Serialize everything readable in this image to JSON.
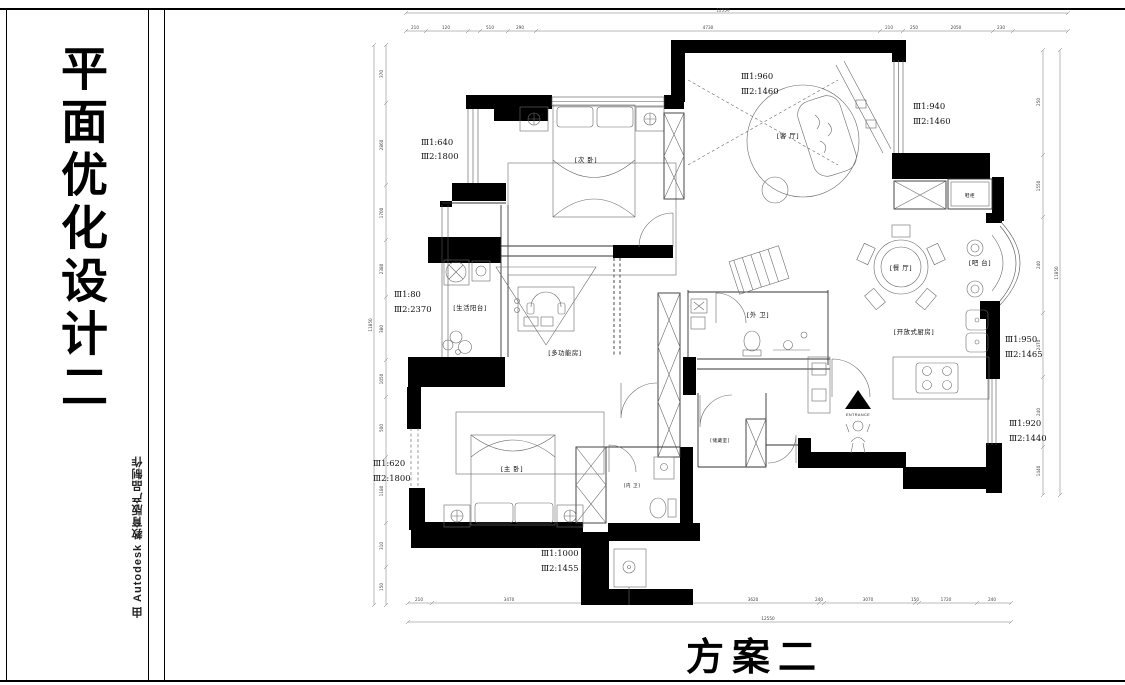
{
  "sheet": {
    "side_title": "平面优化设计二",
    "credit": "由 Autodesk 教育版产品制作",
    "plan_title": "方案二"
  },
  "rooms": {
    "bedroom2": "[次 卧]",
    "living": "[客 厅]",
    "balcony": "[生活阳台]",
    "multi": "[多功能房]",
    "bath_outer": "[外 卫]",
    "dining": "[餐 厅]",
    "bar": "[吧 台]",
    "kitchen": "[开放式厨房]",
    "shoe_cabinet": "鞋柜",
    "master": "[主 卧]",
    "bath_inner": "[内 卫]",
    "storage": "[储藏室]"
  },
  "entrance_label": "ENTRANCE",
  "annotations": {
    "leftTop": {
      "l1": "Ⅲ1:640",
      "l2": "Ⅲ2:1800"
    },
    "top": {
      "l1": "Ⅲ1:960",
      "l2": "Ⅲ2:1460"
    },
    "topRight": {
      "l1": "Ⅲ1:940",
      "l2": "Ⅲ2:1460"
    },
    "leftMid": {
      "l1": "Ⅲ1:80",
      "l2": "Ⅲ2:2370"
    },
    "rightMid": {
      "l1": "Ⅲ1:950",
      "l2": "Ⅲ2:1465"
    },
    "leftBottom": {
      "l1": "Ⅲ1:620",
      "l2": "Ⅲ2:1800"
    },
    "rightLow": {
      "l1": "Ⅲ1:920",
      "l2": "Ⅲ2:1440"
    },
    "bottom": {
      "l1": "Ⅲ1:1000",
      "l2": "Ⅲ2:1455"
    }
  },
  "dims": {
    "top_overall": "12550",
    "bottom_overall": "12550",
    "left_overall": "11850",
    "right_overall": "11850",
    "top": [
      "210",
      "120",
      "510",
      "290",
      "4730",
      "210",
      "250",
      "2050",
      "230"
    ],
    "bottom": [
      "210",
      "3470",
      "240",
      "1110",
      "240",
      "400",
      "240",
      "3620",
      "240",
      "3070",
      "150",
      "1720",
      "240"
    ],
    "left": [
      "370",
      "2860",
      "1700",
      "2380",
      "380",
      "1050",
      "500",
      "1180",
      "310",
      "150"
    ],
    "right": [
      "250",
      "1550",
      "240",
      "2470",
      "240",
      "1440"
    ]
  }
}
